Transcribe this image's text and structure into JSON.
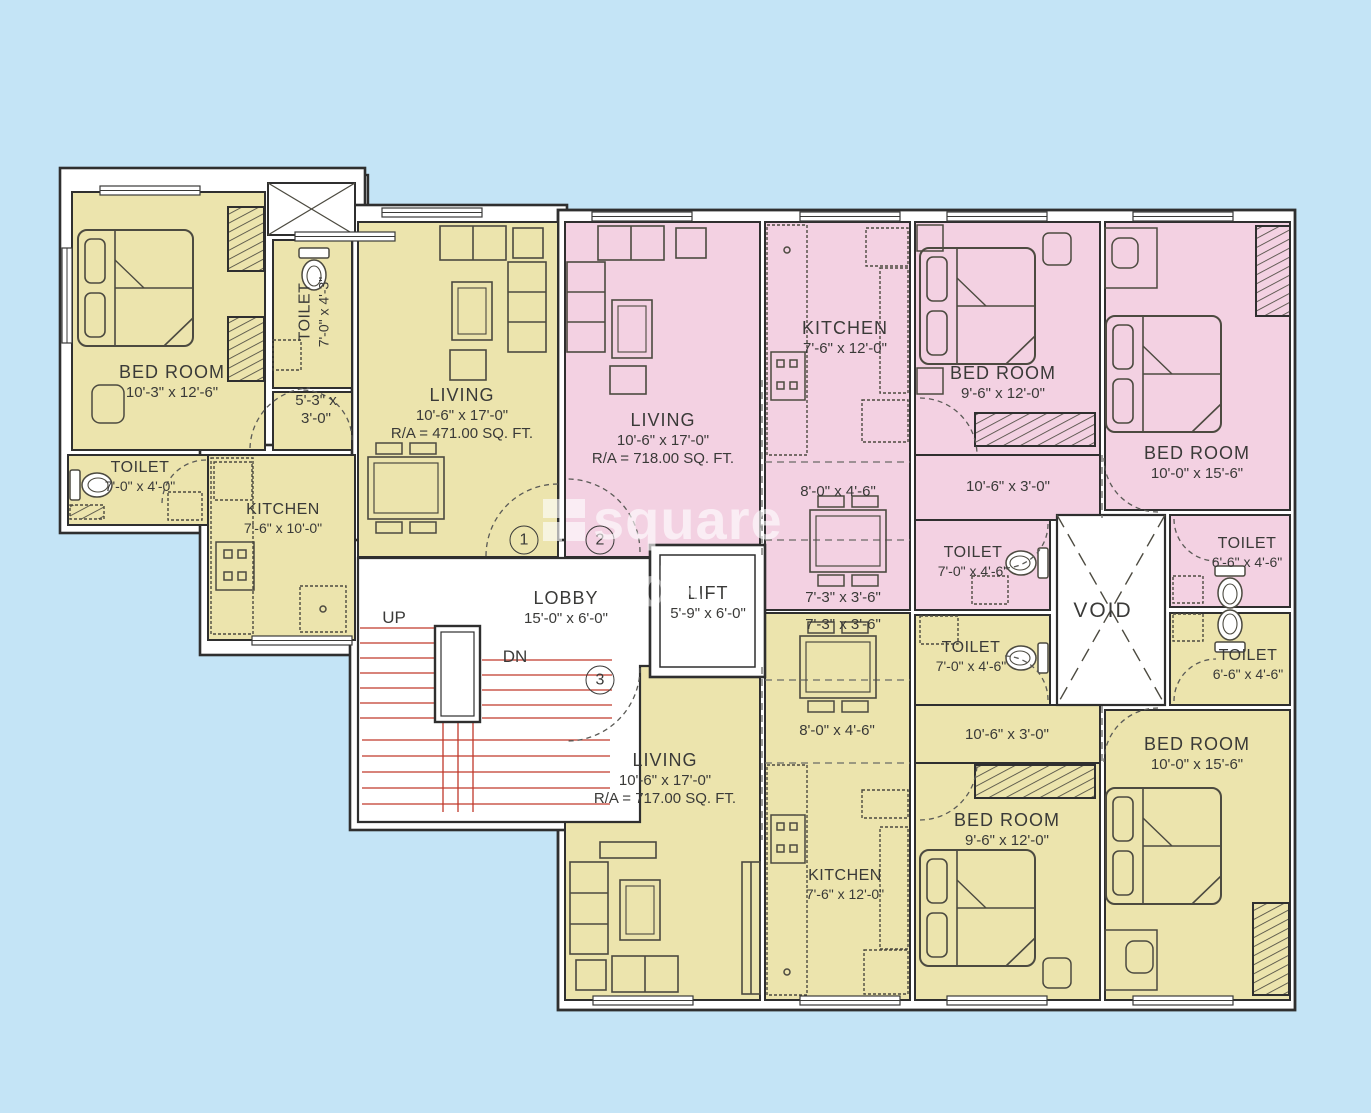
{
  "watermark": {
    "line1": "square",
    "line2": "ds"
  },
  "units": [
    "1",
    "2",
    "3"
  ],
  "stairs": {
    "up": "UP",
    "dn": "DN"
  },
  "colors": {
    "background": "#c4e4f6",
    "unit_yellow": "#ece4ad",
    "unit_pink": "#f3d1e2",
    "wall": "#2f2f2f",
    "stair_red": "#c0392b"
  },
  "rooms": {
    "bedroom1": {
      "name": "BED ROOM",
      "dims": "10'-3\" x 12'-6\""
    },
    "toilet1a": {
      "name": "TOILET",
      "dims": "7'-0\" x 4'-3\""
    },
    "passage1": {
      "dims_l1": "5'-3\" x",
      "dims_l2": "3'-0\""
    },
    "toilet1b": {
      "name": "TOILET",
      "dims": "7'-0\" x 4'-0\""
    },
    "kitchen1": {
      "name": "KITCHEN",
      "dims": "7'-6\" x 10'-0\""
    },
    "living1": {
      "name": "LIVING",
      "dims": "10'-6\" x 17'-0\"",
      "area": "R/A = 471.00 SQ. FT."
    },
    "living2": {
      "name": "LIVING",
      "dims": "10'-6\" x 17'-0\"",
      "area": "R/A = 718.00 SQ. FT."
    },
    "kitchen2": {
      "name": "KITCHEN",
      "dims": "7'-6\" x 12'-0\""
    },
    "bedroom2a": {
      "name": "BED ROOM",
      "dims": "9'-6\" x 12'-0\""
    },
    "bedroom2b": {
      "name": "BED ROOM",
      "dims": "10'-0\" x 15'-6\""
    },
    "dining2a": {
      "dims": "8'-0\" x 4'-6\""
    },
    "dining2b": {
      "dims": "7'-3\" x 3'-6\""
    },
    "passage2": {
      "dims": "10'-6\" x 3'-0\""
    },
    "toilet2a": {
      "name": "TOILET",
      "dims": "7'-0\" x 4'-6\""
    },
    "toilet2b": {
      "name": "TOILET",
      "dims": "6'-6\" x 4'-6\""
    },
    "void": {
      "name": "VOID"
    },
    "lobby": {
      "name": "LOBBY",
      "dims": "15'-0\" x 6'-0\""
    },
    "lift": {
      "name": "LIFT",
      "dims": "5'-9\" x 6'-0\""
    },
    "dining3a": {
      "dims": "7'-3\" x 3'-6\""
    },
    "dining3b": {
      "dims": "8'-0\" x 4'-6\""
    },
    "passage3": {
      "dims": "10'-6\" x 3'-0\""
    },
    "toilet3a": {
      "name": "TOILET",
      "dims": "7'-0\" x 4'-6\""
    },
    "toilet3b": {
      "name": "TOILET",
      "dims": "6'-6\" x 4'-6\""
    },
    "living3": {
      "name": "LIVING",
      "dims": "10'-6\" x 17'-0\"",
      "area": "R/A = 717.00 SQ. FT."
    },
    "kitchen3": {
      "name": "KITCHEN",
      "dims": "7'-6\" x 12'-0\""
    },
    "bedroom3a": {
      "name": "BED ROOM",
      "dims": "9'-6\" x 12'-0\""
    },
    "bedroom3b": {
      "name": "BED ROOM",
      "dims": "10'-0\" x 15'-6\""
    }
  }
}
